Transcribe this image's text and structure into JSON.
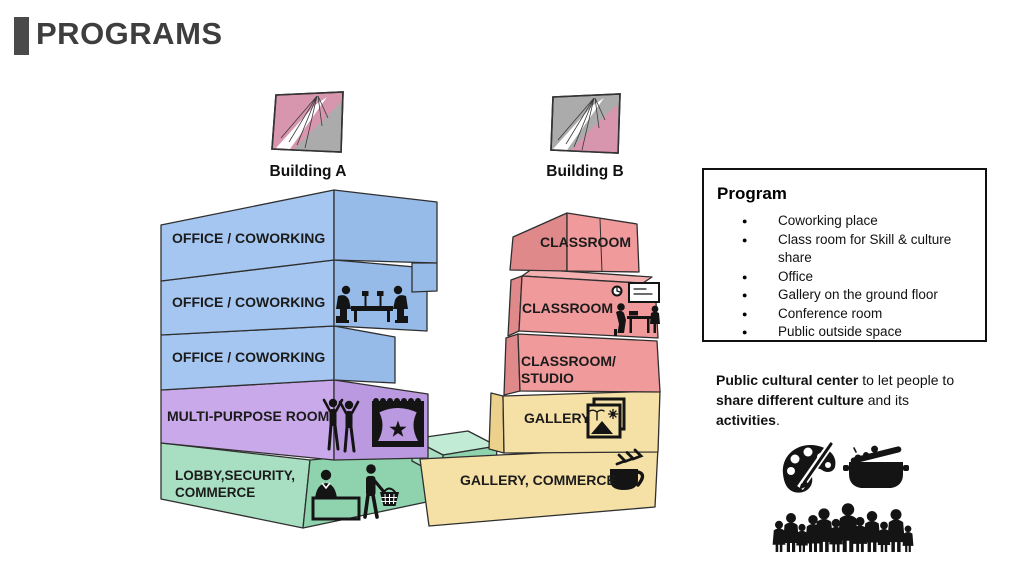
{
  "slide": {
    "title": "PROGRAMS"
  },
  "palette": {
    "blue": "#a5c6f0",
    "blue_side": "#97bbe9",
    "purple": "#c9a9e9",
    "purple_side": "#bb99e0",
    "green": "#a8dfc2",
    "green_side": "#8fd2ae",
    "green_light": "#c2ebd6",
    "pink": "#f09a9b",
    "pink_side": "#e0898b",
    "pink_light": "#f4b0b0",
    "yellow": "#f5e0a6",
    "yellow_side": "#ecd18c",
    "plan_pink": "#d795ae",
    "plan_gray": "#ababab",
    "title_text": "#3e3e3e",
    "outline": "#2f2f2f",
    "icon": "#141414"
  },
  "buildings": {
    "a": {
      "label": "Building A",
      "floors": [
        {
          "label": "OFFICE / COWORKING"
        },
        {
          "label": "OFFICE / COWORKING",
          "icon": "coworking-meeting-icon"
        },
        {
          "label": "OFFICE / COWORKING"
        },
        {
          "label": "MULTI-PURPOSE ROOM",
          "icons": [
            "dancers-icon",
            "stage-curtain-icon"
          ]
        },
        {
          "label": "LOBBY,SECURITY,",
          "label2": "COMMERCE",
          "icons": [
            "receptionist-desk-icon",
            "shopping-basket-icon"
          ]
        }
      ]
    },
    "b": {
      "label": "Building B",
      "floors": [
        {
          "label": "CLASSROOM"
        },
        {
          "label": "CLASSROOM",
          "icon": "classroom-teaching-icon"
        },
        {
          "label": "CLASSROOM/",
          "label2": "STUDIO"
        },
        {
          "label": "GALLERY",
          "icon": "gallery-picture-icon"
        },
        {
          "label": "GALLERY, COMMERCE",
          "icon": "coffee-cup-icon"
        }
      ]
    }
  },
  "program_box": {
    "title": "Program",
    "items": [
      "Coworking place",
      "Class room for Skill & culture share",
      "Office",
      "Gallery on the ground floor",
      "Conference room",
      "Public outside space"
    ]
  },
  "description": {
    "bold1": "Public cultural center",
    "text1": " to let people to ",
    "bold2": "share different culture",
    "text2": " and its ",
    "bold3": "activities",
    "text3": "."
  },
  "footer_icons": [
    "art-palette-icon",
    "cooking-pot-icon",
    "crowd-icon"
  ]
}
